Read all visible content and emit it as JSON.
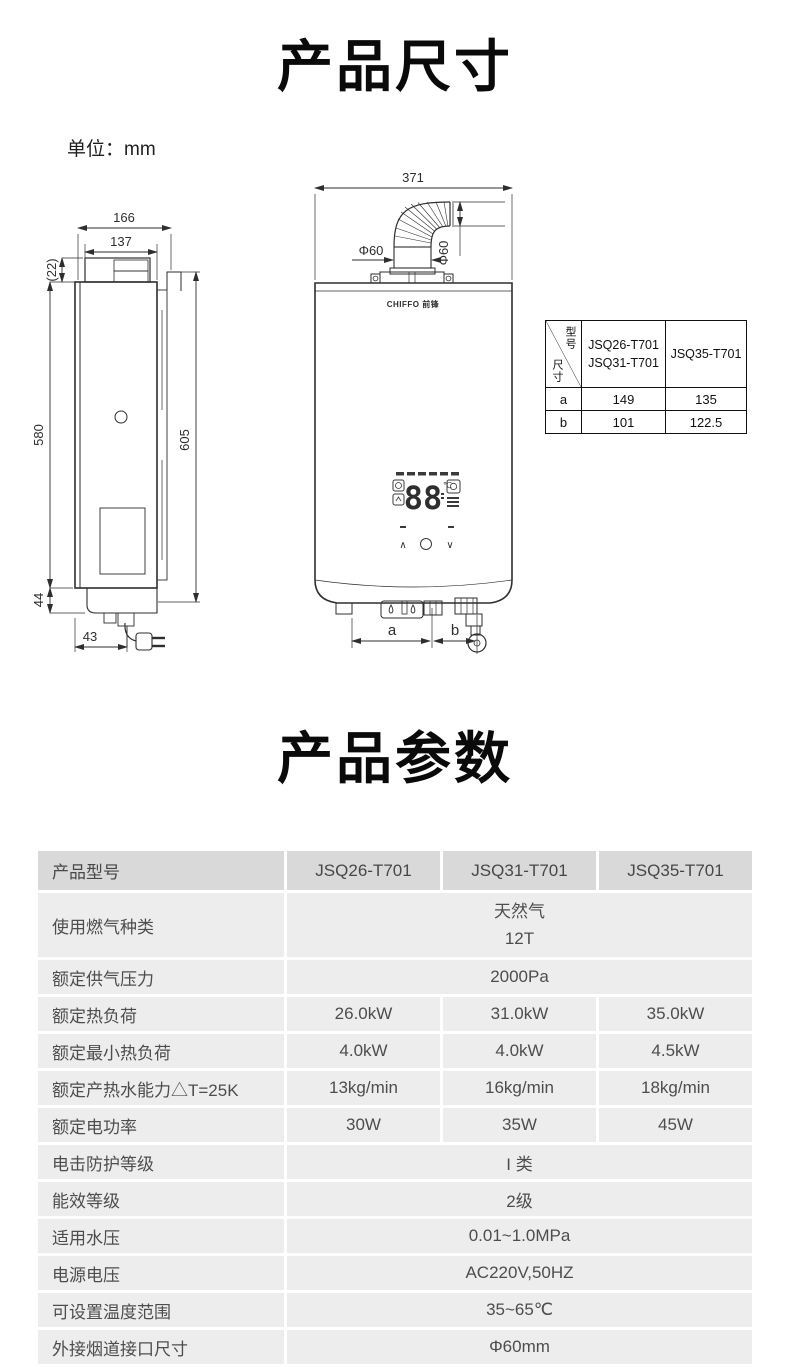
{
  "page": {
    "section1_title": "产品尺寸",
    "unit_label": "单位：mm",
    "section2_title": "产品参数"
  },
  "drawing": {
    "side_view": {
      "d166": "166",
      "d137": "137",
      "d22": "(22)",
      "d580": "580",
      "d605": "605",
      "d44": "44",
      "d43": "43"
    },
    "front_view": {
      "d371": "371",
      "dia_h": "Φ60",
      "dia_v": "Φ60",
      "dim_a": "a",
      "dim_b": "b",
      "brand": "CHIFFO 前锋",
      "display_temp": "88",
      "display_unit": "℃",
      "btn_up": "∧",
      "btn_down": "∨"
    },
    "size_table": {
      "corner_top": "型号",
      "corner_bottom": "尺寸",
      "col1_line1": "JSQ26-T701",
      "col1_line2": "JSQ31-T701",
      "col2": "JSQ35-T701",
      "rows": [
        {
          "label": "a",
          "v1": "149",
          "v2": "135"
        },
        {
          "label": "b",
          "v1": "101",
          "v2": "122.5"
        }
      ]
    }
  },
  "spec_table": {
    "header": {
      "label": "产品型号",
      "models": [
        "JSQ26-T701",
        "JSQ31-T701",
        "JSQ35-T701"
      ]
    },
    "rows": [
      {
        "label": "使用燃气种类",
        "value_lines": [
          "天然气",
          "12T"
        ]
      },
      {
        "label": "额定供气压力",
        "value": "2000Pa"
      },
      {
        "label": "额定热负荷",
        "values": [
          "26.0kW",
          "31.0kW",
          "35.0kW"
        ]
      },
      {
        "label": "额定最小热负荷",
        "values": [
          "4.0kW",
          "4.0kW",
          "4.5kW"
        ]
      },
      {
        "label": "额定产热水能力△T=25K",
        "values": [
          "13kg/min",
          "16kg/min",
          "18kg/min"
        ]
      },
      {
        "label": "额定电功率",
        "values": [
          "30W",
          "35W",
          "45W"
        ]
      },
      {
        "label": "电击防护等级",
        "value": "I 类"
      },
      {
        "label": "能效等级",
        "value": "2级"
      },
      {
        "label": "适用水压",
        "value": "0.01~1.0MPa"
      },
      {
        "label": "电源电压",
        "value": "AC220V,50HZ"
      },
      {
        "label": "可设置温度范围",
        "value": "35~65℃"
      },
      {
        "label": "外接烟道接口尺寸",
        "value": "Φ60mm"
      }
    ]
  },
  "colors": {
    "header_bg": "#d9d9d9",
    "cell_bg": "#ededed",
    "text": "#4d4d4d",
    "line": "#2b2b2b"
  }
}
